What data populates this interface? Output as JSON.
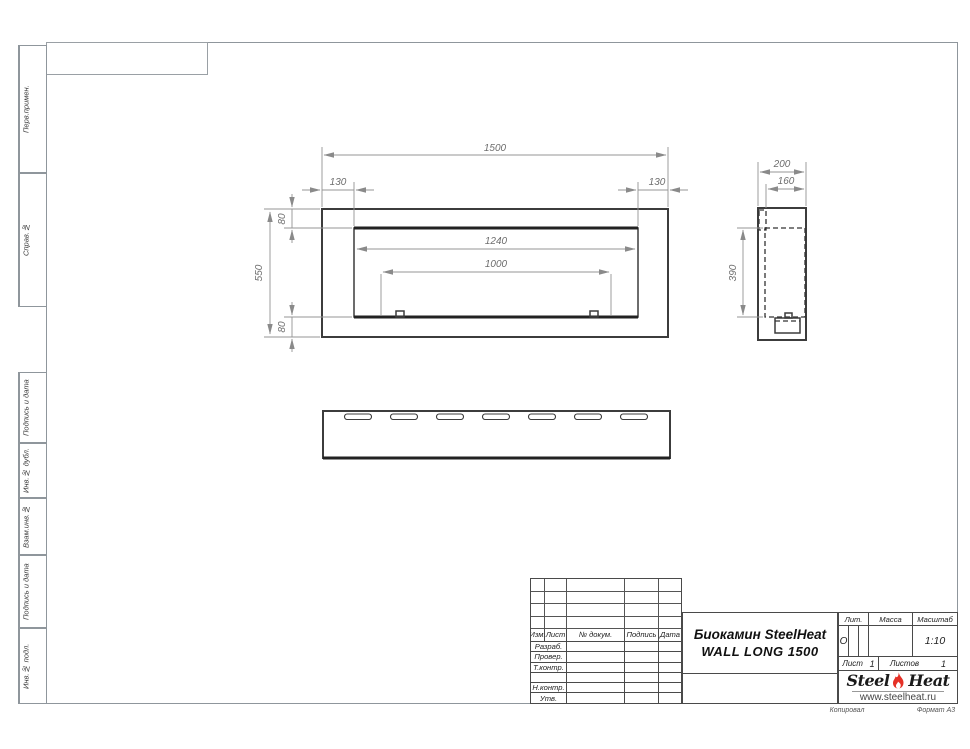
{
  "sheet": {
    "margin_labels": [
      {
        "label": "Перв.примен."
      },
      {
        "label": "Справ.№"
      },
      {
        "label": "Подпись и дата"
      },
      {
        "label": "Инв.№ дубл."
      },
      {
        "label": "Взам.инв.№"
      },
      {
        "label": "Подпись и дата"
      },
      {
        "label": "Инв.№ подл."
      }
    ],
    "footer": {
      "copied": "Копировал",
      "format": "Формат А3"
    }
  },
  "title_block": {
    "header_cols": {
      "izm": "Изм.",
      "list": "Лист",
      "doc": "№ докум.",
      "sign": "Подпись",
      "date": "Дата"
    },
    "rows": {
      "r1": "Разраб.",
      "r2": "Провер.",
      "r3": "Т.контр.",
      "r4": "Н.контр.",
      "r5": "Утв."
    },
    "title_line1": "Биокамин SteelHeat",
    "title_line2": "WALL LONG 1500",
    "lit_label": "Лит.",
    "lit_value": "О",
    "mass_label": "Масса",
    "scale_label": "Масштаб",
    "scale_value": "1:10",
    "sheet_label": "Лист",
    "sheet_num": "1",
    "sheets_label": "Листов",
    "sheets_num": "1",
    "logo_steel": "Steel",
    "logo_heat": "Heat",
    "logo_url": "www.steelheat.ru",
    "flame_color": "#e53026"
  },
  "drawing": {
    "front": {
      "width": "1500",
      "height": "550",
      "inset_left": "130",
      "inset_right": "130",
      "inset_top": "80",
      "inset_bottom": "80",
      "opening_width": "1240",
      "burner_width": "1000"
    },
    "side": {
      "depth": "200",
      "inner_depth": "160",
      "opening_height": "390"
    },
    "top": {
      "slot_count": 7
    }
  }
}
